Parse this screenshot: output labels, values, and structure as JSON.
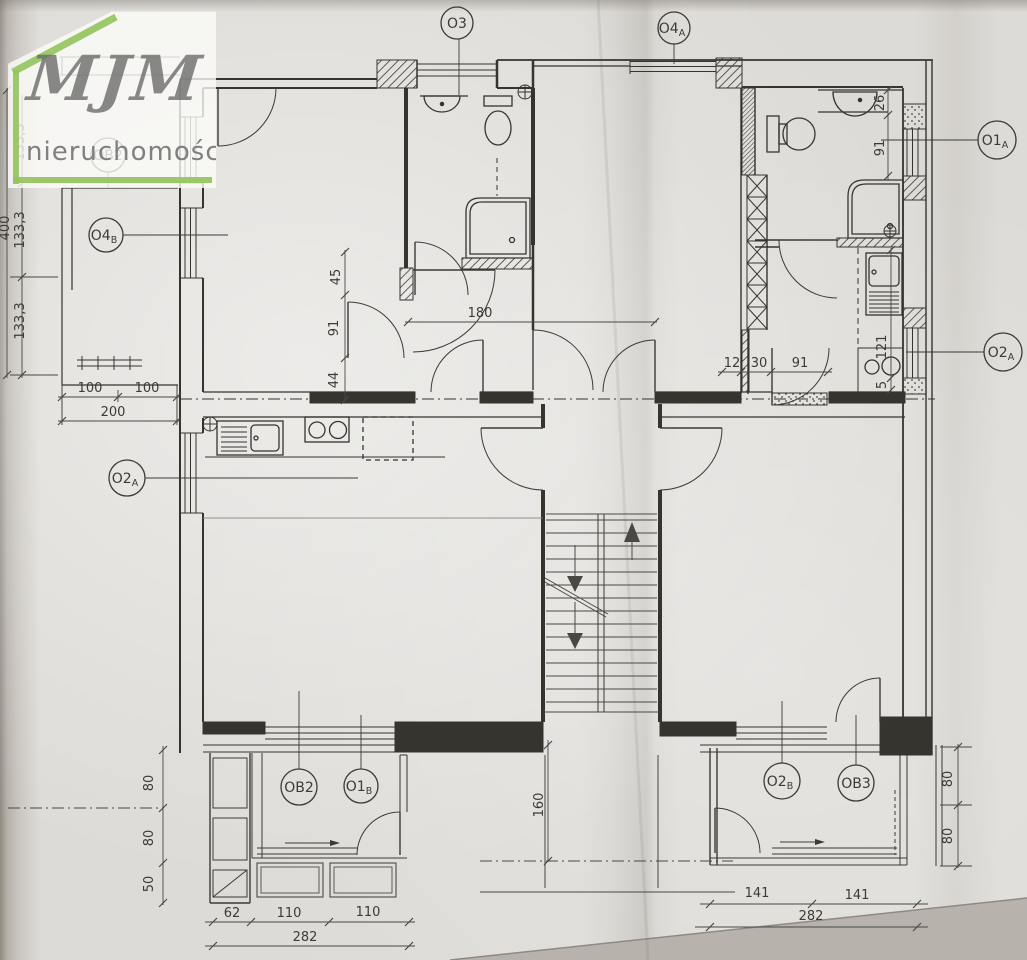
{
  "logo": {
    "title": "MJM",
    "subtitle": "nieruchomości"
  },
  "colors": {
    "accent_green": "#94c45c",
    "ink": "#3b3a35",
    "paper": "#dddbd7"
  },
  "labels": {
    "ob2_top": {
      "main": "OB2",
      "sub": ""
    },
    "o4b": {
      "main": "O4",
      "sub": "B"
    },
    "o3": {
      "main": "O3",
      "sub": ""
    },
    "o4a": {
      "main": "O4",
      "sub": "A"
    },
    "o1a": {
      "main": "O1",
      "sub": "A"
    },
    "o2a_right": {
      "main": "O2",
      "sub": "A"
    },
    "o2a_left": {
      "main": "O2",
      "sub": "A"
    },
    "ob2_bottom": {
      "main": "OB2",
      "sub": ""
    },
    "o1b": {
      "main": "O1",
      "sub": "B"
    },
    "o2b": {
      "main": "O2",
      "sub": "B"
    },
    "ob3": {
      "main": "OB3",
      "sub": ""
    }
  },
  "dims": {
    "left_133a": "133,3",
    "left_400": "400",
    "left_133b": "133,3",
    "left_133c": "133,3",
    "left_100a": "100",
    "left_100b": "100",
    "left_200": "200",
    "mid_45": "45",
    "mid_91": "91",
    "mid_44": "44",
    "mid_180": "180",
    "rt_26": "26",
    "rt_91": "91",
    "rm_12": "12",
    "rm_30": "30",
    "rm_91": "91",
    "rm_121": "121",
    "rm_5": "5",
    "bl_80a": "80",
    "bl_80b": "80",
    "bl_50": "50",
    "bb_62": "62",
    "bb_110a": "110",
    "bb_110b": "110",
    "bb_282": "282",
    "bc_160": "160",
    "br_141a": "141",
    "br_141b": "141",
    "br_282": "282",
    "brv_80a": "80",
    "brv_80b": "80"
  }
}
